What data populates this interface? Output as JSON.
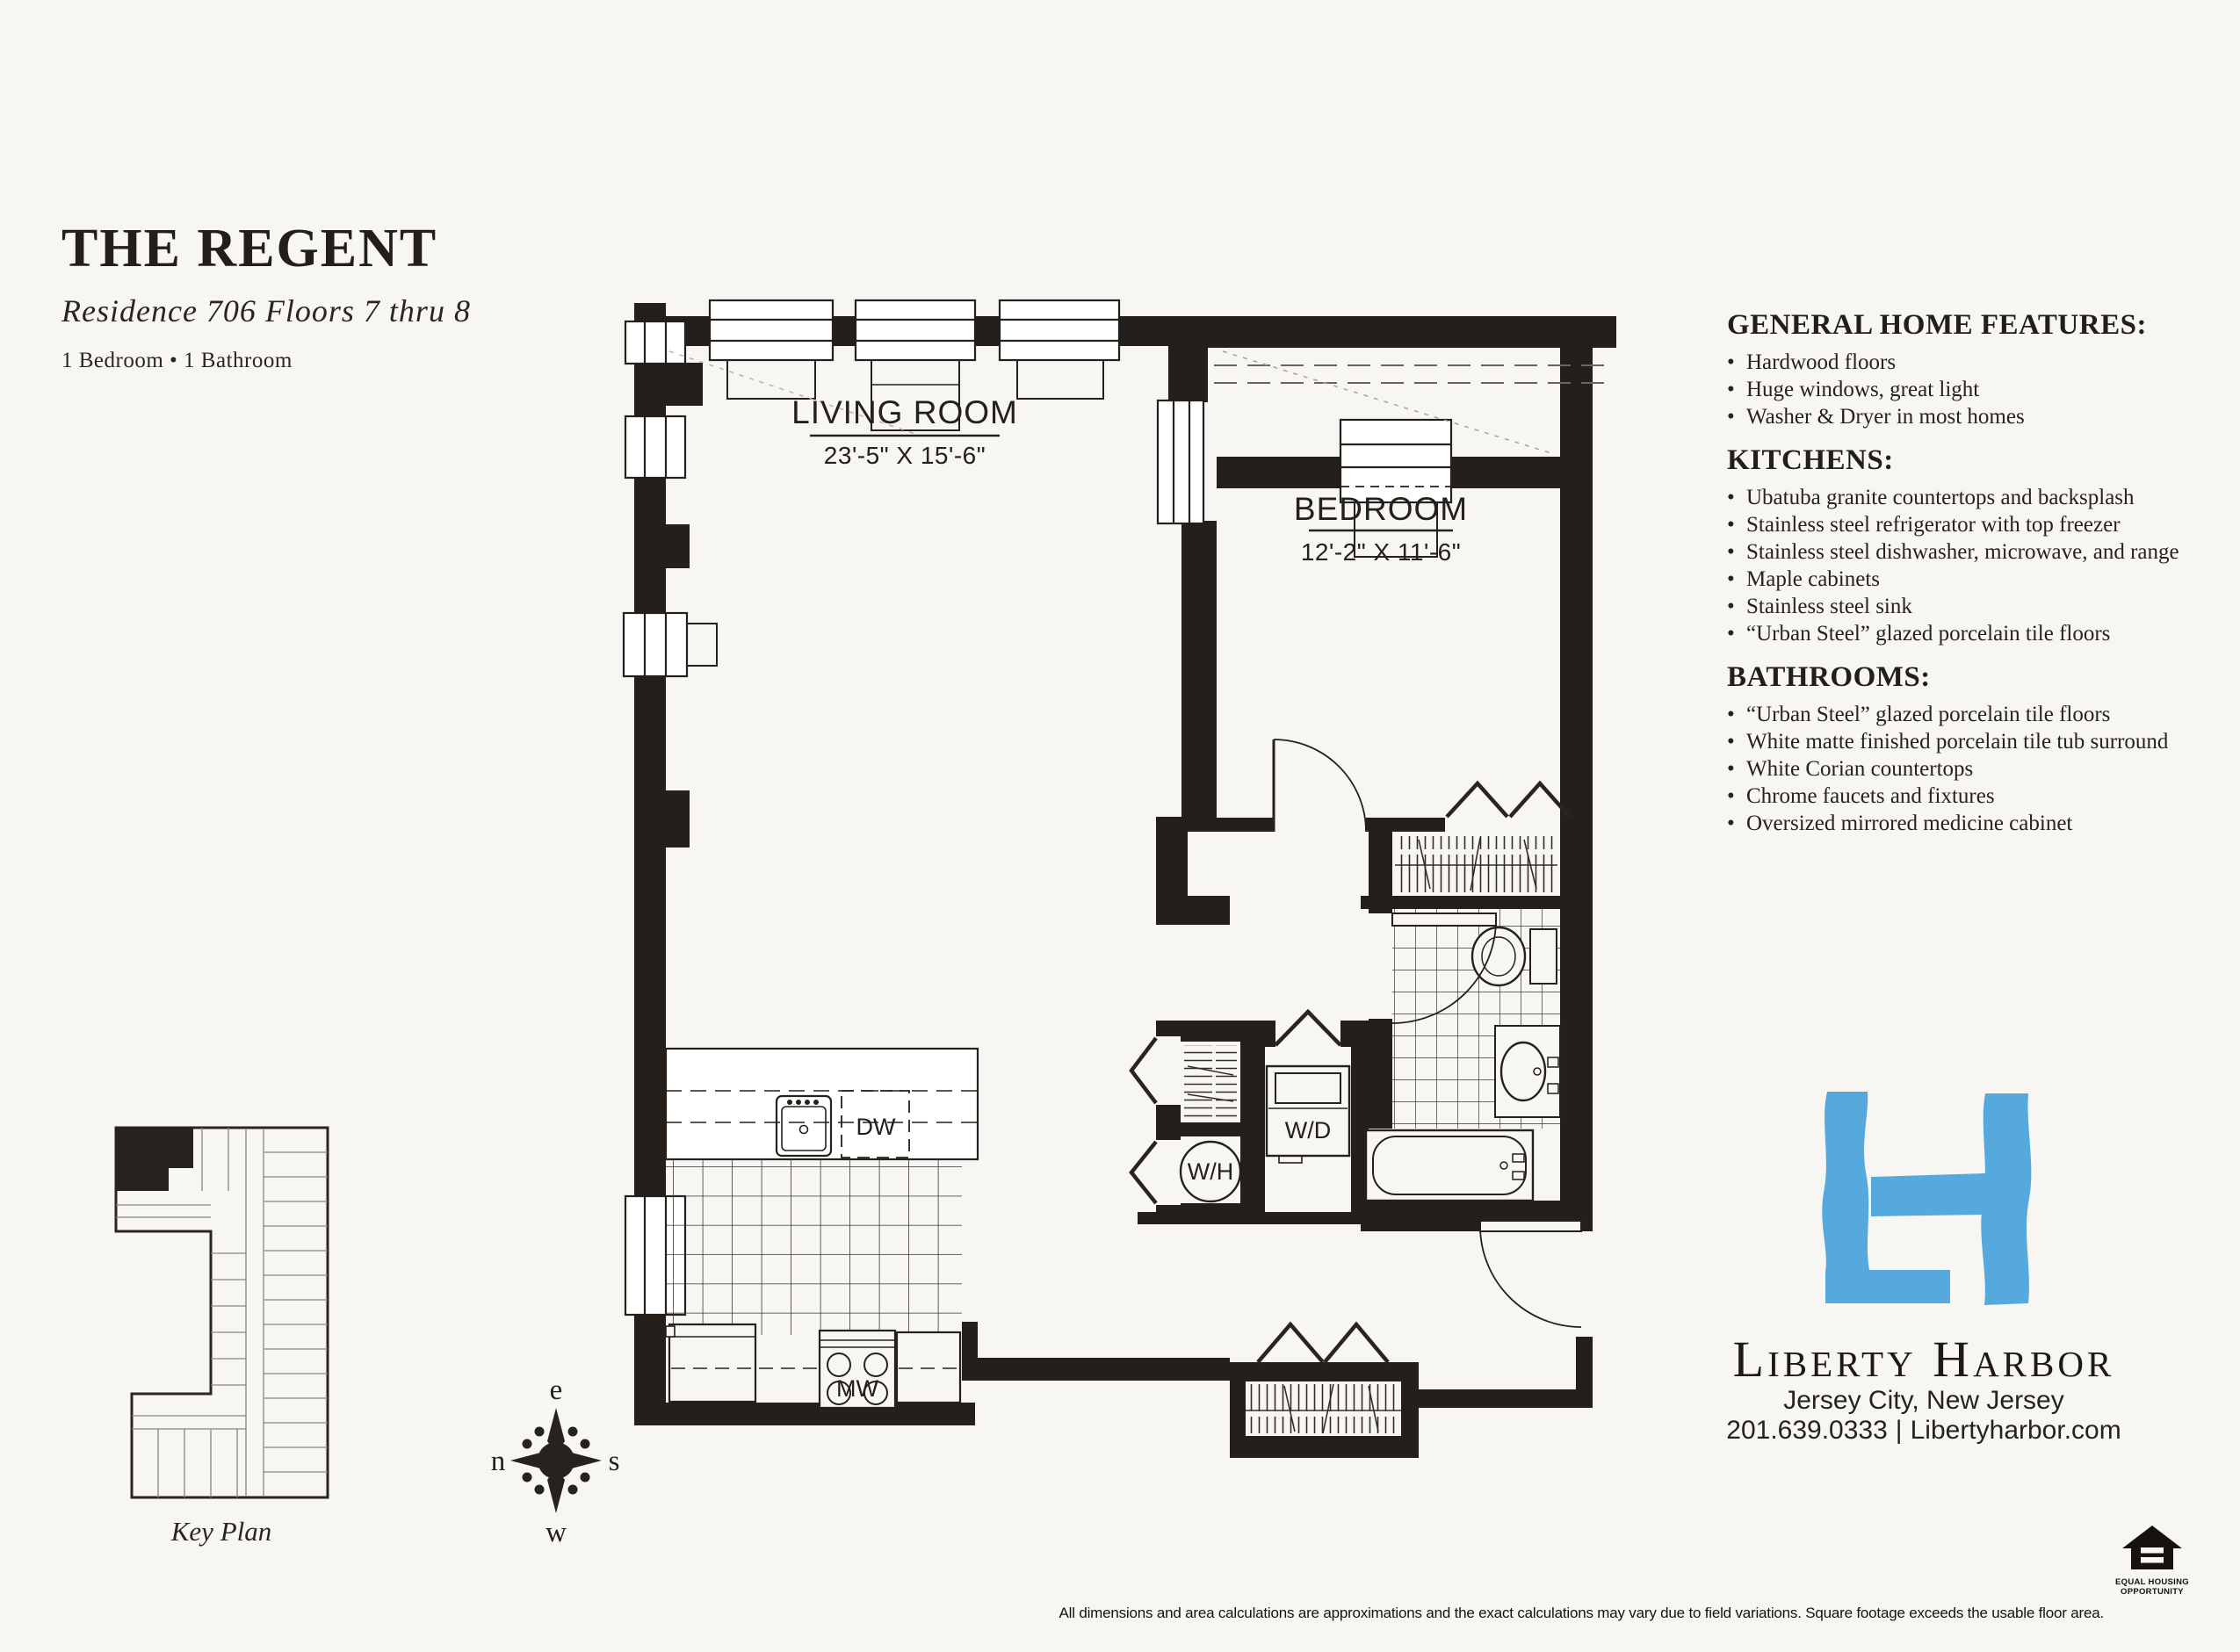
{
  "header": {
    "title": "THE REGENT",
    "subtitle": "Residence 706 Floors 7 thru 8",
    "meta": "1 Bedroom • 1 Bathroom"
  },
  "features": {
    "bullet": "•",
    "sections": [
      {
        "heading": "GENERAL HOME FEATURES:",
        "items": [
          "Hardwood floors",
          "Huge windows, great light",
          "Washer & Dryer in most homes"
        ]
      },
      {
        "heading": "KITCHENS:",
        "items": [
          "Ubatuba granite countertops and backsplash",
          "Stainless steel refrigerator with top freezer",
          "Stainless steel dishwasher, microwave, and range",
          "Maple cabinets",
          "Stainless steel sink",
          "“Urban Steel” glazed porcelain tile floors"
        ]
      },
      {
        "heading": "BATHROOMS:",
        "items": [
          "“Urban Steel” glazed porcelain tile floors",
          "White matte finished porcelain tile tub surround",
          "White Corian countertops",
          "Chrome faucets and fixtures",
          "Oversized mirrored medicine cabinet"
        ]
      }
    ]
  },
  "plan": {
    "living_room": {
      "name": "LIVING ROOM",
      "dims": "23'-5\" X 15'-6\""
    },
    "bedroom": {
      "name": "BEDROOM",
      "dims": "12'-2\" X 11'-6\""
    },
    "washer_dryer": "W/D",
    "water_heater": "W/H",
    "dishwasher": "DW",
    "microwave": "MW"
  },
  "compass": {
    "top": "e",
    "left": "n",
    "right": "s",
    "bottom": "w"
  },
  "key_plan": {
    "label": "Key Plan"
  },
  "brand": {
    "name": "Liberty Harbor",
    "city": "Jersey City, New Jersey",
    "phone": "201.639.0333",
    "separator": "|",
    "website": "Libertyharbor.com",
    "logo_color": "#55A9DC"
  },
  "footer": {
    "disclaimer": "All dimensions and area calculations are approximations and the exact calculations may vary due to field variations. Square footage exceeds the usable floor area.",
    "equal_housing": {
      "line1": "EQUAL HOUSING",
      "line2": "OPPORTUNITY"
    }
  }
}
